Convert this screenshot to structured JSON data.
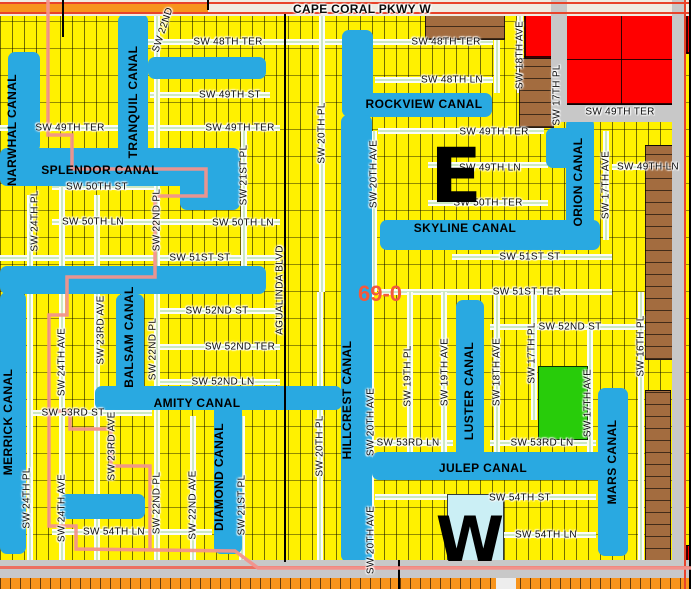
{
  "map": {
    "width": 691,
    "height": 589,
    "colors": {
      "parcel_yellow": "#FFF100",
      "canal_blue": "#29A9E1",
      "street_green_center": "#9CD38B",
      "road_gray": "#C8C8C8",
      "topbar_cream": "#F0ECE2",
      "highway_orange": "#F7941D",
      "boundary_pink": "#F2928C",
      "road_red_line": "#E8432A",
      "road_pink_line": "#EC6F60",
      "parcel_red": "#FF0000",
      "parcel_brown": "#A36C3F",
      "parcel_green": "#28CC0A",
      "parcel_lightblue": "#CBEFF5",
      "district_text": "#F4583C"
    },
    "region_letters": {
      "east": {
        "text": "E",
        "x": 456,
        "y": 176,
        "size": 76
      },
      "west": {
        "text": "W",
        "x": 470,
        "y": 540,
        "size": 62
      }
    },
    "district_label": {
      "text": "69-0",
      "x": 380,
      "y": 294,
      "size": 22
    },
    "canal_labels": [
      {
        "t": "NARWHAL CANAL",
        "x": 12,
        "y": 130,
        "r": -90
      },
      {
        "t": "TRANQUIL CANAL",
        "x": 133,
        "y": 102,
        "r": -90
      },
      {
        "t": "SPLENDOR CANAL",
        "x": 100,
        "y": 170,
        "r": 0
      },
      {
        "t": "ROCKVIEW CANAL",
        "x": 424,
        "y": 104,
        "r": 0
      },
      {
        "t": "SKYLINE CANAL",
        "x": 465,
        "y": 228,
        "r": 0
      },
      {
        "t": "ORION CANAL",
        "x": 578,
        "y": 182,
        "r": -90
      },
      {
        "t": "MERRICK CANAL",
        "x": 8,
        "y": 422,
        "r": -90
      },
      {
        "t": "BALSAM CANAL",
        "x": 129,
        "y": 337,
        "r": -90
      },
      {
        "t": "AMITY CANAL",
        "x": 197,
        "y": 403,
        "r": 0
      },
      {
        "t": "DIAMOND CANAL",
        "x": 219,
        "y": 477,
        "r": -90
      },
      {
        "t": "HILLCREST CANAL",
        "x": 347,
        "y": 400,
        "r": -90
      },
      {
        "t": "LUSTER CANAL",
        "x": 469,
        "y": 391,
        "r": -90
      },
      {
        "t": "JULEP CANAL",
        "x": 483,
        "y": 468,
        "r": 0
      },
      {
        "t": "MARS CANAL",
        "x": 612,
        "y": 462,
        "r": -90
      }
    ],
    "street_labels": [
      {
        "t": "CAPE CORAL PKWY W",
        "x": 362,
        "y": 9,
        "s": 12,
        "b": 1
      },
      {
        "t": "SW 48TH TER",
        "x": 228,
        "y": 42
      },
      {
        "t": "SW 48TH TER",
        "x": 446,
        "y": 42
      },
      {
        "t": "SW 48TH LN",
        "x": 452,
        "y": 80
      },
      {
        "t": "SW 49TH ST",
        "x": 230,
        "y": 95
      },
      {
        "t": "SW 49TH TER",
        "x": 620,
        "y": 112
      },
      {
        "t": "SW 49TH TER",
        "x": 70,
        "y": 128
      },
      {
        "t": "SW 49TH TER",
        "x": 240,
        "y": 128
      },
      {
        "t": "SW 49TH TER",
        "x": 494,
        "y": 132
      },
      {
        "t": "SW 49TH LN",
        "x": 490,
        "y": 168
      },
      {
        "t": "SW 49TH LN",
        "x": 648,
        "y": 167
      },
      {
        "t": "SW 50TH ST",
        "x": 97,
        "y": 187
      },
      {
        "t": "SW 50TH TER",
        "x": 488,
        "y": 203
      },
      {
        "t": "SW 50TH LN",
        "x": 93,
        "y": 222
      },
      {
        "t": "SW 50TH LN",
        "x": 243,
        "y": 223
      },
      {
        "t": "SW 51ST ST",
        "x": 200,
        "y": 258
      },
      {
        "t": "SW 51ST ST",
        "x": 530,
        "y": 257
      },
      {
        "t": "SW 51ST TER",
        "x": 527,
        "y": 292
      },
      {
        "t": "SW 52ND ST",
        "x": 217,
        "y": 311
      },
      {
        "t": "SW 52ND ST",
        "x": 570,
        "y": 327
      },
      {
        "t": "SW 52ND TER",
        "x": 240,
        "y": 347
      },
      {
        "t": "SW 52ND LN",
        "x": 223,
        "y": 382
      },
      {
        "t": "SW 53RD ST",
        "x": 73,
        "y": 413
      },
      {
        "t": "SW 53RD LN",
        "x": 408,
        "y": 443
      },
      {
        "t": "SW 53RD LN",
        "x": 542,
        "y": 443
      },
      {
        "t": "SW 54TH ST",
        "x": 520,
        "y": 498
      },
      {
        "t": "SW 54TH LN",
        "x": 114,
        "y": 532
      },
      {
        "t": "SW 54TH LN",
        "x": 546,
        "y": 535
      },
      {
        "t": "AGUALINDA BLVD",
        "x": 280,
        "y": 290,
        "r": -90
      },
      {
        "t": "SW 24TH PL",
        "x": 35,
        "y": 221,
        "r": -90
      },
      {
        "t": "SW 24TH PL",
        "x": 27,
        "y": 498,
        "r": -90
      },
      {
        "t": "SW 24TH AVE",
        "x": 62,
        "y": 362,
        "r": -90
      },
      {
        "t": "SW 24TH AVE",
        "x": 62,
        "y": 508,
        "r": -90
      },
      {
        "t": "SW 23RD AVE",
        "x": 101,
        "y": 330,
        "r": -90
      },
      {
        "t": "SW 23RD AVE",
        "x": 112,
        "y": 446,
        "r": -90
      },
      {
        "t": "SW 22ND PL",
        "x": 157,
        "y": 220,
        "r": -90
      },
      {
        "t": "SW 22ND PL",
        "x": 153,
        "y": 349,
        "r": -90
      },
      {
        "t": "SW 22ND PL",
        "x": 157,
        "y": 503,
        "r": -90
      },
      {
        "t": "SW 22ND AVE",
        "x": 193,
        "y": 505,
        "r": -90
      },
      {
        "t": "SW 21ST PL",
        "x": 244,
        "y": 175,
        "r": -90
      },
      {
        "t": "SW 21ST PL",
        "x": 242,
        "y": 505,
        "r": -90
      },
      {
        "t": "SW 20TH PL",
        "x": 322,
        "y": 133,
        "r": -90
      },
      {
        "t": "SW 20TH PL",
        "x": 320,
        "y": 446,
        "r": -90
      },
      {
        "t": "SW 20TH AVE",
        "x": 374,
        "y": 174,
        "r": -90
      },
      {
        "t": "SW 20TH AVE",
        "x": 371,
        "y": 422,
        "r": -90
      },
      {
        "t": "SW 20TH AVE",
        "x": 371,
        "y": 540,
        "r": -90
      },
      {
        "t": "SW 19TH PL",
        "x": 408,
        "y": 376,
        "r": -90
      },
      {
        "t": "SW 19TH AVE",
        "x": 445,
        "y": 372,
        "r": -90
      },
      {
        "t": "SW 18TH AVE",
        "x": 497,
        "y": 372,
        "r": -90
      },
      {
        "t": "SW 18TH AVE",
        "x": 520,
        "y": 55,
        "r": -90
      },
      {
        "t": "SW 17TH PL",
        "x": 557,
        "y": 95,
        "r": -90
      },
      {
        "t": "SW 17TH PL",
        "x": 532,
        "y": 353,
        "r": -90
      },
      {
        "t": "SW 17TH AVE",
        "x": 606,
        "y": 185,
        "r": -90
      },
      {
        "t": "SW 17TH AVE",
        "x": 588,
        "y": 403,
        "r": -90
      },
      {
        "t": "SW 16TH PL",
        "x": 641,
        "y": 346,
        "r": -90
      },
      {
        "t": "SW 22ND",
        "x": 163,
        "y": 30,
        "r": -72
      }
    ],
    "canals": [
      [
        8,
        52,
        32,
        100
      ],
      [
        118,
        14,
        30,
        150
      ],
      [
        148,
        57,
        118,
        22
      ],
      [
        0,
        148,
        215,
        38
      ],
      [
        180,
        148,
        60,
        62
      ],
      [
        342,
        30,
        31,
        85
      ],
      [
        342,
        93,
        150,
        24
      ],
      [
        341,
        115,
        31,
        447
      ],
      [
        380,
        220,
        220,
        30
      ],
      [
        566,
        118,
        28,
        130
      ],
      [
        546,
        128,
        26,
        40
      ],
      [
        0,
        266,
        266,
        28
      ],
      [
        116,
        294,
        28,
        100
      ],
      [
        95,
        386,
        247,
        24
      ],
      [
        0,
        292,
        26,
        262
      ],
      [
        214,
        404,
        28,
        150
      ],
      [
        456,
        300,
        28,
        158
      ],
      [
        372,
        452,
        238,
        28
      ],
      [
        598,
        388,
        30,
        168
      ],
      [
        60,
        494,
        85,
        25
      ],
      [
        520,
        580,
        16,
        9
      ]
    ],
    "streets_h": [
      [
        42,
        148,
        493
      ],
      [
        80,
        375,
        493
      ],
      [
        95,
        150,
        270
      ],
      [
        128,
        0,
        280
      ],
      [
        131,
        378,
        544
      ],
      [
        165,
        428,
        548
      ],
      [
        167,
        612,
        672
      ],
      [
        187,
        52,
        158
      ],
      [
        203,
        428,
        548
      ],
      [
        222,
        52,
        280
      ],
      [
        258,
        0,
        280
      ],
      [
        257,
        452,
        612
      ],
      [
        292,
        378,
        612
      ],
      [
        311,
        158,
        280
      ],
      [
        327,
        490,
        672
      ],
      [
        347,
        158,
        280
      ],
      [
        382,
        158,
        280
      ],
      [
        413,
        28,
        152
      ],
      [
        443,
        372,
        453
      ],
      [
        443,
        490,
        596
      ],
      [
        497,
        375,
        596
      ],
      [
        532,
        52,
        212
      ],
      [
        535,
        488,
        596
      ]
    ],
    "streets_v": [
      [
        30,
        195,
        560
      ],
      [
        62,
        187,
        560
      ],
      [
        97,
        195,
        560
      ],
      [
        157,
        16,
        560
      ],
      [
        193,
        416,
        560
      ],
      [
        244,
        128,
        292
      ],
      [
        242,
        416,
        560
      ],
      [
        322,
        16,
        292
      ],
      [
        320,
        292,
        560
      ],
      [
        374,
        131,
        292
      ],
      [
        371,
        292,
        560
      ],
      [
        410,
        292,
        452
      ],
      [
        444,
        292,
        452
      ],
      [
        497,
        16,
        93
      ],
      [
        497,
        292,
        452
      ],
      [
        520,
        16,
        93
      ],
      [
        534,
        292,
        420
      ],
      [
        606,
        131,
        240
      ],
      [
        590,
        327,
        452
      ],
      [
        641,
        292,
        560
      ]
    ],
    "special_parcels": {
      "red": [
        [
          562,
          14,
          121,
          91
        ],
        [
          524,
          12,
          28,
          46
        ],
        [
          634,
          0,
          24,
          8
        ],
        [
          686,
          8,
          5,
          46
        ],
        [
          686,
          545,
          5,
          18
        ]
      ],
      "brown": [
        [
          425,
          14,
          80,
          26
        ],
        [
          519,
          58,
          35,
          70
        ],
        [
          645,
          145,
          28,
          215
        ],
        [
          645,
          390,
          26,
          172
        ]
      ],
      "green": [
        [
          538,
          366,
          50,
          74
        ]
      ],
      "lightblue": [
        [
          447,
          494,
          57,
          68
        ]
      ]
    },
    "roads": {
      "topbar": [
        0,
        0,
        691,
        16
      ],
      "gray_rects": [
        [
          551,
          0,
          16,
          122
        ],
        [
          551,
          105,
          122,
          17
        ],
        [
          672,
          0,
          14,
          589
        ],
        [
          0,
          560,
          691,
          18
        ]
      ],
      "orange_rects": [
        [
          0,
          4,
          208,
          8
        ],
        [
          0,
          578,
          691,
          11
        ]
      ],
      "white_rects": [
        [
          496,
          578,
          20,
          11
        ]
      ],
      "red_lines": [
        [
          0,
          2,
          691,
          2
        ],
        [
          0,
          12,
          691,
          2
        ],
        [
          684,
          0,
          2,
          589
        ]
      ],
      "pink_lines": [
        [
          0,
          566,
          691,
          3
        ]
      ],
      "black_lines_v": [
        [
          284,
          14,
          548
        ],
        [
          62,
          0,
          37
        ],
        [
          207,
          0,
          10
        ],
        [
          689,
          0,
          589
        ],
        [
          398,
          560,
          29
        ]
      ]
    },
    "boundary_paths": [
      "48,0 48,135 72,135 72,169 206,169 206,196 155,196 155,277 67,277 67,315 49,315 49,526 76,526 76,549 235,551 258,568 691,568",
      "49,411 70,411 70,429 111,429 111,466 150,466 150,549"
    ]
  }
}
